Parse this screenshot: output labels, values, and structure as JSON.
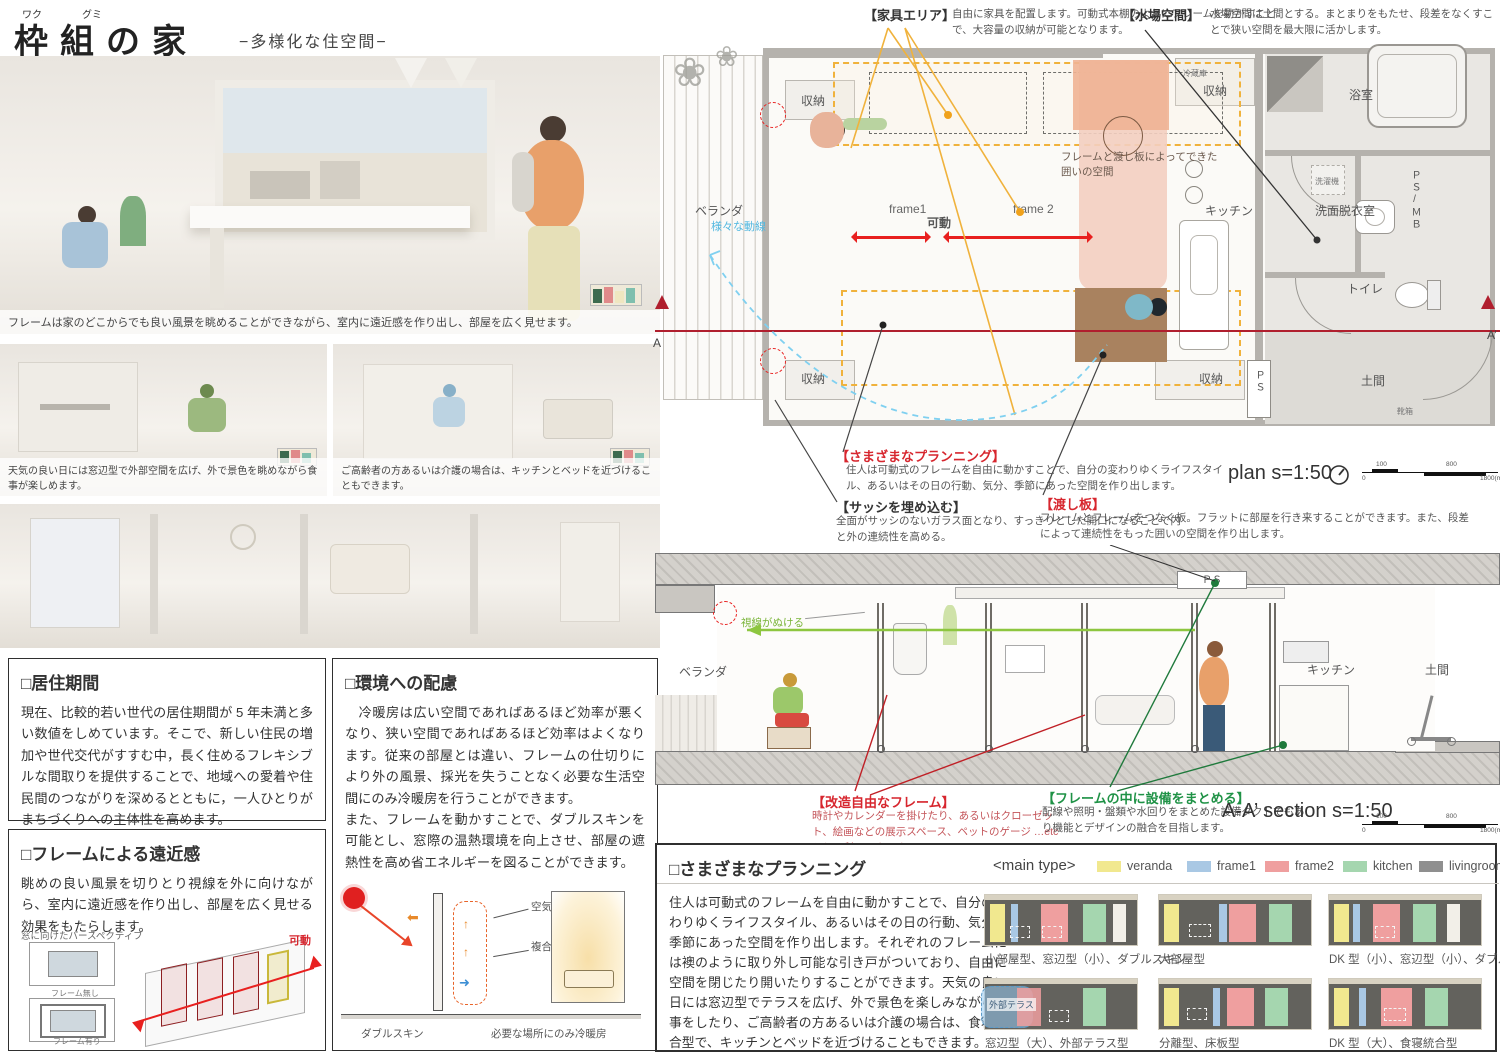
{
  "header": {
    "furigana_waku": "ワク",
    "furigana_gumi": "グミ",
    "title": "枠組の家",
    "subtitle": "−多様化な住空間−"
  },
  "renders": {
    "main_caption": "フレームは家のどこからでも良い風景を眺めることができながら、室内に遠近感を作り出し、部屋を広く見せます。",
    "left_caption": "天気の良い日には窓辺型で外部空間を広げ、外で景色を眺めながら食事が楽しめます。",
    "right_caption": "ご高齢者の方あるいは介護の場合は、キッチンとベッドを近づけることもできます。"
  },
  "residence_box": {
    "title": "□居住期間",
    "body": "現在、比較的若い世代の居住期間が 5 年未満と多い数値をしめています。そこで、新しい住民の増加や世代交代がすすむ中，長く住めるフレキシブルな間取りを提供することで、地域への愛着や住民間のつながりを深めるとともに，一人ひとりがまちづくりへの主体性を高めます。"
  },
  "perspective_box": {
    "title": "□フレームによる遠近感",
    "body": "眺めの良い風景を切りとり視線を外に向けながら、室内に遠近感を作り出し、部屋を広く見せる効果をもたらします。",
    "diagram_caption": "窓に向けたパースペクティブ",
    "label_no_frame": "フレーム無し",
    "label_with_frame": "フレーム有り",
    "label_movable": "可動"
  },
  "environment_box": {
    "title": "□環境への配慮",
    "body1": "　冷暖房は広い空間であればあるほど効率が悪くなり、狭い空間であればあるほど効率はよくなります。従来の部屋とは違い、フレームの仕切りにより外の風景、採光を失うことなく必要な生活空間にのみ冷暖房を行うことができます。",
    "body2": "また、フレームを動かすことで、ダブルスキンを可能とし、窓際の温熱環境を向上させ、部屋の遮熱性を高め省エネルギーを図ることができます。",
    "label_air": "空気層",
    "label_glass": "複合ガラス",
    "label_double_skin": "ダブルスキン",
    "label_local": "必要な場所にのみ冷暖房"
  },
  "plan": {
    "furniture_note_title": "【家具エリア】",
    "furniture_note_body": "自由に家具を配置します。可動式本棚のようにフレームを動かすことで、大容量の収納が可能となります。",
    "water_note_title": "【水場空間】",
    "water_note_body": "水場空間は土間とする。まとまりをもたせ、段差をなくすことで狭い空間を最大限に活かします。",
    "labels": {
      "veranda": "ベランダ",
      "flow": "様々な動線",
      "storage_tl": "収納",
      "storage_tr": "収納",
      "storage_bl": "収納",
      "storage_br": "収納",
      "fridge": "冷蔵庫",
      "frame1": "frame1",
      "frame2": "frame 2",
      "movable": "可動",
      "enclosure": "フレームと渡し板によってできた囲いの空間",
      "kitchen": "キッチン",
      "bath": "浴室",
      "washer": "洗濯機",
      "psmb": "ＰＳ/ＭＢ",
      "washroom": "洗面脱衣室",
      "toilet": "トイレ",
      "doma": "土間",
      "shoes": "靴箱",
      "ps": "ＰＳ",
      "a": "A",
      "a_prime": "A’"
    },
    "scale_label": "plan s=1:50",
    "ticks": {
      "zero": "0",
      "t100": "100",
      "t800": "800",
      "t1800": "1800(mm)"
    }
  },
  "plan_notes": {
    "planning_title": "【さまざまなプランニング】",
    "planning_body": "住人は可動式のフレームを自由に動かすことで、自分の変わりゆくライフスタイル、あるいはその日の行動、気分、季節にあった空間を作り出します。",
    "sash_title": "【サッシを埋め込む】",
    "sash_body": "全面がサッシのないガラス面となり、すっきりとした開口になることで内と外の連続性を高める。",
    "board_title": "【渡し板】",
    "board_body": "フレームとフレームをつなぐ板。フラットに部屋を行き来することができます。また、段差によって連続性をもった囲いの空間を作り出します。"
  },
  "section": {
    "labels": {
      "veranda": "ベランダ",
      "sightline": "視線がぬける",
      "ps": "ＰＳ",
      "kitchen": "キッチン",
      "doma": "土間"
    },
    "frame_note_title": "【改造自由なフレーム】",
    "frame_note_body": "時計やカレンダーを掛けたり、あるいはクローゼット、絵画などの展示スペース、ペットのゲージ …etc として利用できます。",
    "equip_note_title": "【フレームの中に設備をまとめる】",
    "equip_note_body": "配線や照明・盤類や水回りをまとめた設備ダクトでもあり機能とデザインの融合を目指します。",
    "scale_label": "A-A’ section s=1:50",
    "ticks": {
      "zero": "0",
      "t100": "100",
      "t800": "800",
      "t1800": "1800(mm)"
    }
  },
  "planning_panel": {
    "title": "□さまざまなプランニング",
    "body": "住人は可動式のフレームを自由に動かすことで、自分の変わりゆくライフスタイル、あるいはその日の行動、気分、季節にあった空間を作り出します。それぞれのフレームには襖のように取り外し可能な引き戸がついており、自由に空間を閉じたり開いたりすることができます。天気の良い日には窓辺型でテラスを広げ、外で景色を楽しみながら食事をしたり、ご高齢者の方あるいは介護の場合は、食寝統合型で、キッチンとベッドを近づけることもできます。",
    "legend_title": "<main type>",
    "legend": [
      {
        "label": "veranda",
        "color": "#f1e88f"
      },
      {
        "label": "frame1",
        "color": "#a9c8e4"
      },
      {
        "label": "frame2",
        "color": "#ef9f9f"
      },
      {
        "label": "kitchen",
        "color": "#a5d6af"
      },
      {
        "label": "livingroom",
        "color": "#8f8f8f"
      },
      {
        "label": "bed space",
        "color": "dashed-white"
      }
    ],
    "terrace_label": "外部テラス",
    "types": [
      {
        "label": "小部屋型、窓辺型（小）、ダブルスキン"
      },
      {
        "label": "大部屋型"
      },
      {
        "label": "DK 型（小）、窓辺型（小）、ダブルスキン"
      },
      {
        "label": "窓辺型（大）、外部テラス型"
      },
      {
        "label": "分離型、床板型"
      },
      {
        "label": "DK 型（大）、食寝統合型"
      }
    ]
  },
  "accent_colors": {
    "annotation_red": "#d7262e",
    "annotation_green": "#1f9246",
    "movable_arrow_red": "#e8201f",
    "section_cut_red": "#b01f2e",
    "furniture_orange": "#f0b23c",
    "flow_blue": "#7fd0f0",
    "sight_green": "#8dc63f"
  }
}
